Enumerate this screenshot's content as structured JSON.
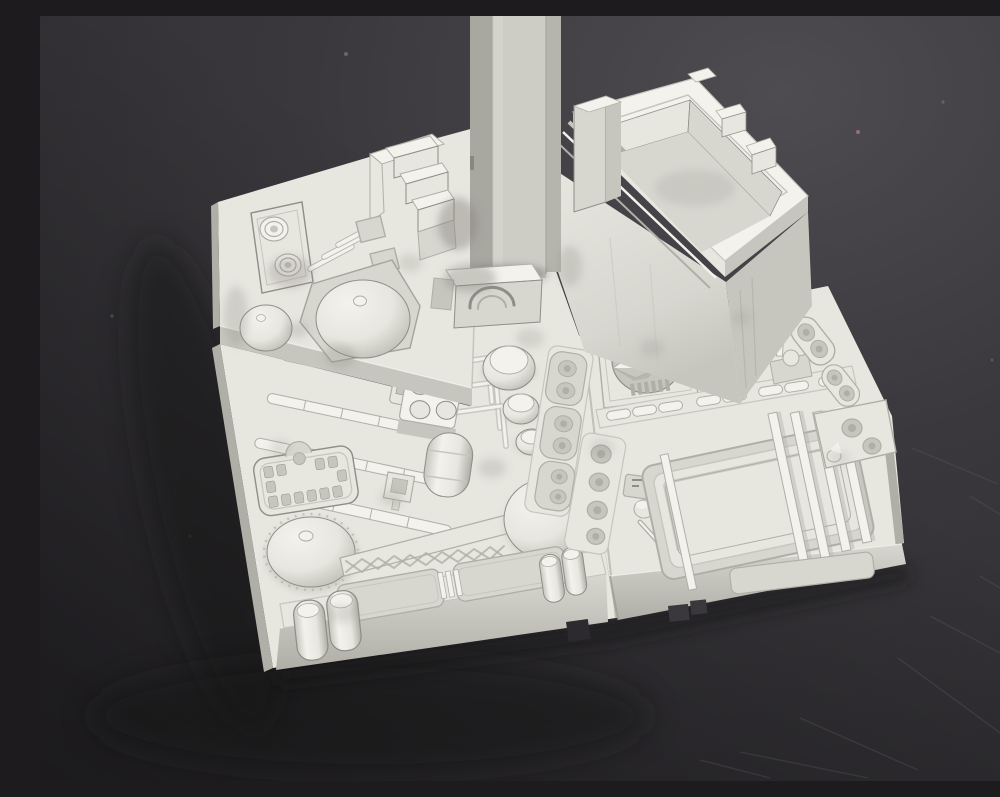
{
  "meta": {
    "type": "photograph",
    "description": "Unpainted light gray plastic scale-model greeble panel (mechanical detail tile) with a square support rod rising out of the top of the frame, photographed on a dark gray scratched tabletop",
    "lighting": "soft top light, brighter upper right background, soft cast shadow to lower left"
  },
  "subject": {
    "material": "light gray styrene with subtle dark weathering wash",
    "parts": [
      {
        "name": "support-rod",
        "desc": "square vertical rod exiting the top edge of frame"
      },
      {
        "name": "rod-socket-arch",
        "desc": "weathered socket block with concentric arch rings at rod base"
      },
      {
        "name": "open-box",
        "desc": "raised open-topped square housing with stepped rim, upright slab and stepped tabs"
      },
      {
        "name": "terrace-panel",
        "desc": "raised upper-left terrace"
      },
      {
        "name": "twin-port-bar",
        "desc": "raised bar with two concentric round ports"
      },
      {
        "name": "diagonal-ribs",
        "desc": "three parallel raised ribs"
      },
      {
        "name": "stair-blocks",
        "desc": "stepped staircase blocks beside the rod"
      },
      {
        "name": "large-dome",
        "desc": "shallow dome with nipple in faceted recess"
      },
      {
        "name": "small-dome",
        "desc": "small dome on terrace corner"
      },
      {
        "name": "pipe-bank",
        "desc": "four rows of segmented pipes with right-angle branch lines"
      },
      {
        "name": "ladder-grid",
        "desc": "rectangular grid strip"
      },
      {
        "name": "stud-block",
        "desc": "block with four round studs"
      },
      {
        "name": "canister-stack",
        "desc": "three round canisters of decreasing size"
      },
      {
        "name": "capsule-tank",
        "desc": "rounded capsule tank"
      },
      {
        "name": "grate-panel",
        "desc": "rounded panel ringed with small slots"
      },
      {
        "name": "front-dome",
        "desc": "large dome with nipple and toothed rim"
      },
      {
        "name": "lattice-girder",
        "desc": "X-braced girder joining the domes"
      },
      {
        "name": "center-dome",
        "desc": "dome beside the girder"
      },
      {
        "name": "front-skirt",
        "desc": "front band with inset rounded rectangles"
      },
      {
        "name": "twin-canisters",
        "desc": "paired round-topped canisters"
      },
      {
        "name": "wedge-dial-panel",
        "desc": "panel with circular recess and raised wedge pointer"
      },
      {
        "name": "segmented-pipe-bar",
        "desc": "bar of pill-shaped pipe segments"
      },
      {
        "name": "port-strips",
        "desc": "columns of round ports in rounded frames"
      },
      {
        "name": "piston-greeble",
        "desc": "small piston and ball fitting"
      },
      {
        "name": "finned-tray",
        "desc": "recessed tray with four parallel fins"
      },
      {
        "name": "corner-port-block",
        "desc": "corner block with round ports and cone"
      }
    ]
  },
  "palette": {
    "bg-top": "#4e4c50",
    "bg-mid": "#3a383c",
    "bg-dark": "#2c2a2e",
    "shadow": "#141218",
    "p-bright": "#f3f2ec",
    "p-light": "#e7e6df",
    "p-mid": "#d7d6cf",
    "p-dim": "#c7c6be",
    "p-shade": "#b0afa7",
    "p-dark": "#8f8e86",
    "line": "#a5a49c",
    "weather": "#87867f",
    "rod-left": "#a8a7a0",
    "rod-front": "#cecdc5",
    "rod-right": "#b6b5ad",
    "speck": "#b97f7f"
  }
}
